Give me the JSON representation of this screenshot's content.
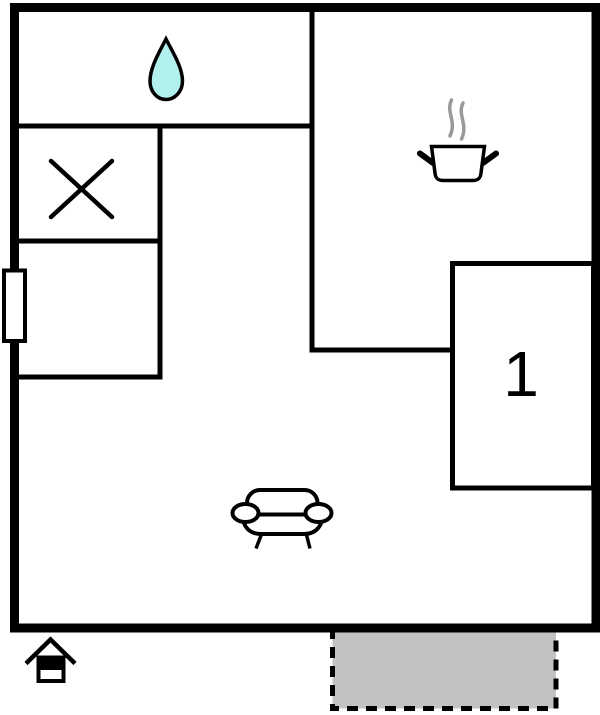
{
  "floorplan": {
    "title": "Floor plan",
    "rooms": {
      "bedroom_1": {
        "label": "1",
        "symbol": "room-number"
      },
      "bathroom": {
        "symbol": "water-drop-icon"
      },
      "shower_room": {
        "symbol": "x-mark-icon"
      },
      "kitchen": {
        "symbol": "cooking-pot-icon"
      },
      "living_area": {
        "symbol": "sofa-icon"
      },
      "terrace": {
        "symbol": "dashed-gray-area"
      },
      "entrance": {
        "symbol": "house-icon"
      }
    },
    "colors": {
      "wall": "#000000",
      "background": "#ffffff",
      "water_drop": "#b2f0ee",
      "steam": "#999999",
      "terrace_fill": "#c2c2c2",
      "terrace_border": "#000000"
    }
  }
}
